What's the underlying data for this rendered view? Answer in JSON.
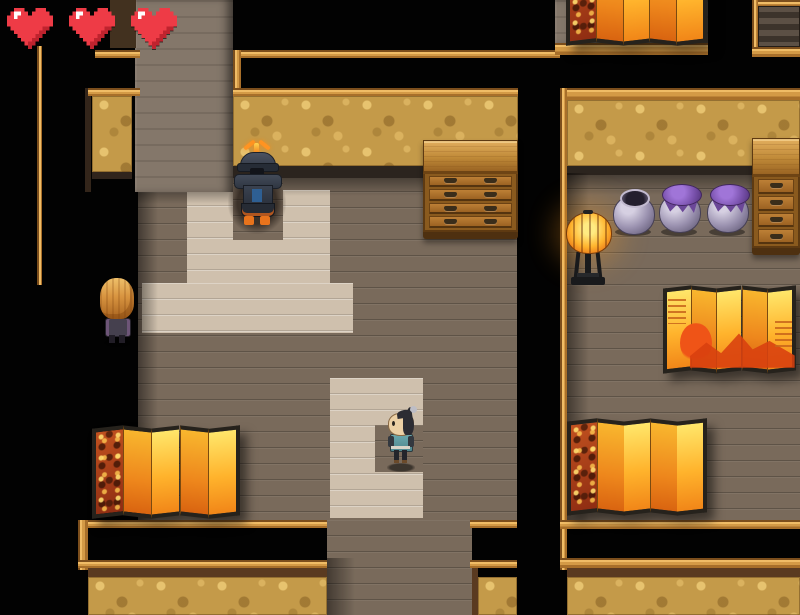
{
  "hud": {
    "hearts": {
      "count": 3,
      "fill": "#ee3b46",
      "highlight": "#ffffff",
      "shade": "#bf232e"
    }
  },
  "scene": {
    "description": "Top-down Japanese interior with wood-plank rooms, raised light platforms and dark corridors",
    "characters": {
      "armored_samurai": {
        "label": "armored samurai NPC",
        "x": 227,
        "y": 142,
        "w": 60,
        "h": 97
      },
      "blonde_visitor": {
        "label": "long blonde-haired NPC",
        "x": 96,
        "y": 276,
        "w": 42,
        "h": 73
      },
      "topknot_villager": {
        "label": "topknot villager",
        "x": 380,
        "y": 407,
        "w": 42,
        "h": 66
      }
    },
    "furniture": {
      "dresser_center": {
        "label": "wooden chest of drawers",
        "x": 423,
        "y": 140,
        "w": 95,
        "h": 99,
        "drawers": 4,
        "handles_per_drawer": 2
      },
      "dresser_right": {
        "label": "wooden chest of drawers (clipped at edge)",
        "x": 752,
        "y": 138,
        "w": 48,
        "h": 117,
        "drawers": 4,
        "handles_per_drawer": 1
      },
      "floor_lamp": {
        "label": "paper lantern floor lamp",
        "x": 563,
        "y": 212,
        "w": 50,
        "h": 76
      },
      "pot_open": {
        "label": "open ceramic pot",
        "x": 612,
        "y": 186,
        "w": 42,
        "h": 50
      },
      "pot_capped_1": {
        "label": "cloth-capped pot",
        "x": 658,
        "y": 184,
        "w": 47,
        "h": 52
      },
      "pot_capped_2": {
        "label": "cloth-capped pot",
        "x": 706,
        "y": 184,
        "w": 46,
        "h": 52
      },
      "byobu_top_right": {
        "label": "gold folding screen (clipped at top)",
        "x": 566,
        "y": -50,
        "w": 141,
        "h": 94,
        "panels": 5,
        "art": "floral"
      },
      "byobu_mid_right": {
        "label": "sunset folding screen",
        "x": 663,
        "y": 287,
        "w": 133,
        "h": 85,
        "panels": 5,
        "art": "sunset"
      },
      "byobu_bottom_left": {
        "label": "gold folding screen",
        "x": 92,
        "y": 427,
        "w": 148,
        "h": 90,
        "panels": 5,
        "art": "floral"
      },
      "byobu_bottom_right": {
        "label": "gold folding screen",
        "x": 567,
        "y": 420,
        "w": 140,
        "h": 94,
        "panels": 5,
        "art": "floral"
      }
    }
  },
  "palette": {
    "floor_dark": "#796a5b",
    "floor_light": "#cfc0ad",
    "cork_wall": "#c49a49",
    "wood_trim": "#d49a46",
    "wall_gray": "#84776a",
    "screen_gold": "#ffb32c",
    "screen_red": "#d8400f",
    "pot_purple": "#7b53ae",
    "lantern_yellow": "#ffb42e",
    "heart_red": "#ee3b46"
  }
}
